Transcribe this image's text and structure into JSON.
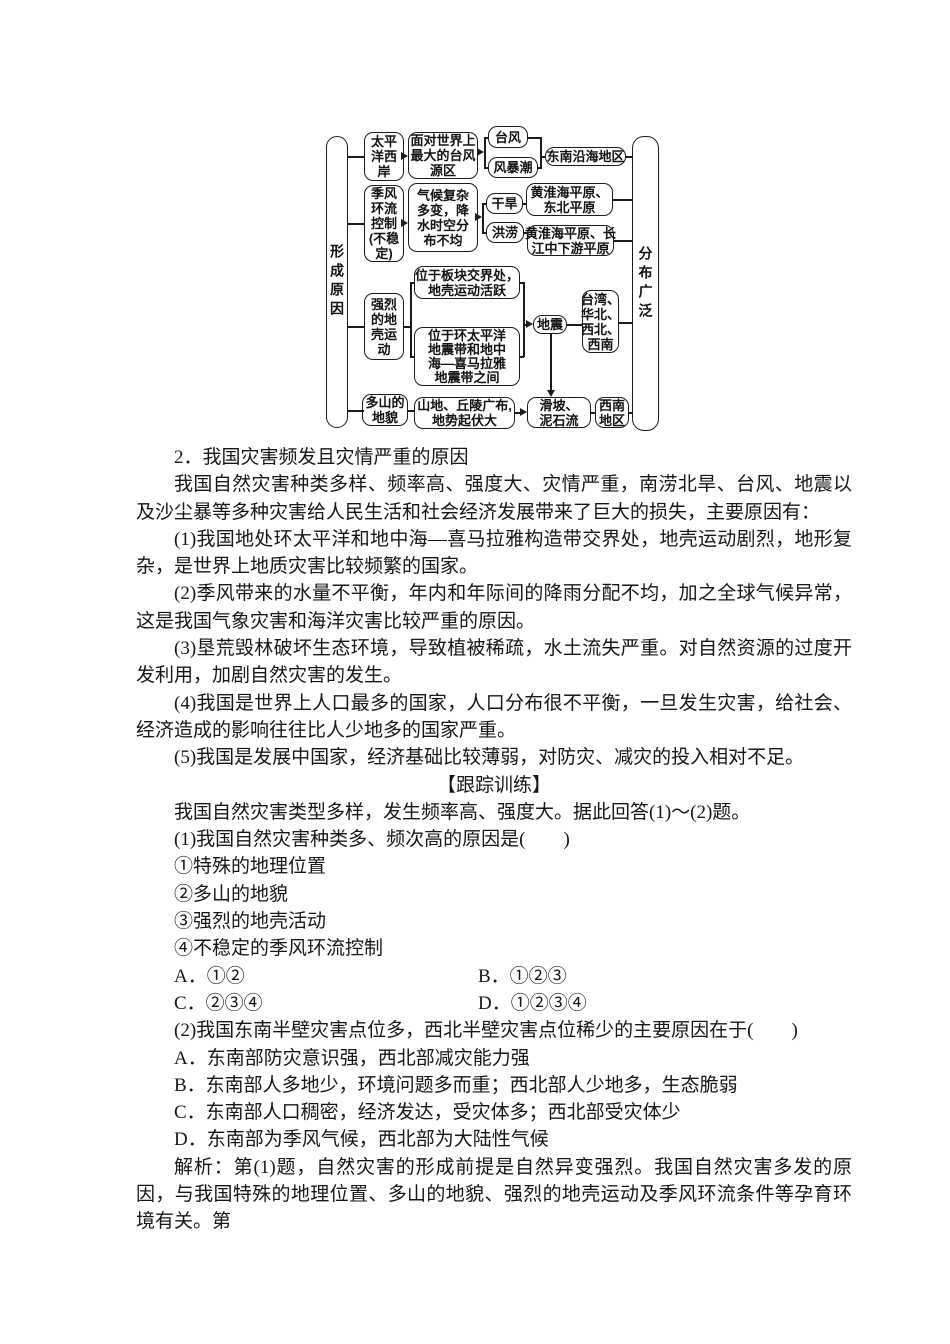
{
  "flowchart": {
    "cause_label": "形成原因",
    "distribution_label": "分布广泛",
    "nodes": {
      "pacific": "太平\n洋西\n岸",
      "monsoon": "季风\n环流\n控制\n(不稳\n定)",
      "crust": "强烈\n的地\n壳运\n动",
      "mountain": "多山的\n地貌",
      "typhoon_source": "面对世界上\n最大的台风\n源区",
      "climate": "气候复杂\n多变，降\n水时空分\n布不均",
      "plate_boundary": "位于板块交界处，\n地壳运动活跃",
      "seismic_belts": "位于环太平洋\n地震带和地中\n海—喜马拉雅\n地震带之间",
      "terrain": "山地、丘陵广布,\n地势起伏大",
      "typhoon": "台风",
      "storm_surge": "风暴潮",
      "drought": "干旱",
      "flood": "洪涝",
      "earthquake": "地震",
      "landslide": "滑坡、\n泥石流",
      "se_coast": "东南沿海地区",
      "huanghuai_northeast": "黄淮海平原、\n东北平原",
      "huanghuai_yangtze": "黄淮海平原、长\n江中下游平原",
      "tw_hb_xb_xn": "台湾、\n华北、\n西北、\n西南",
      "southwest": "西南\n地区"
    }
  },
  "body": {
    "blocks": [
      {
        "text": "2．我国灾害频发且灾情严重的原因"
      },
      {
        "text": "我国自然灾害种类多样、频率高、强度大、灾情严重，南涝北旱、台风、地震以及沙尘暴等多种灾害给人民生活和社会经济发展带来了巨大的损失，主要原因有："
      },
      {
        "text": "(1)我国地处环太平洋和地中海—喜马拉雅构造带交界处，地壳运动剧烈，地形复杂，是世界上地质灾害比较频繁的国家。"
      },
      {
        "text": "(2)季风带来的水量不平衡，年内和年际间的降雨分配不均，加之全球气候异常，这是我国气象灾害和海洋灾害比较严重的原因。"
      },
      {
        "text": "(3)垦荒毁林破坏生态环境，导致植被稀疏，水土流失严重。对自然资源的过度开发利用，加剧自然灾害的发生。"
      },
      {
        "text": "(4)我国是世界上人口最多的国家，人口分布很不平衡，一旦发生灾害，给社会、经济造成的影响往往比人少地多的国家严重。"
      },
      {
        "text": "(5)我国是发展中国家，经济基础比较薄弱，对防灾、减灾的投入相对不足。"
      },
      {
        "text": "【跟踪训练】"
      },
      {
        "text": "我国自然灾害类型多样，发生频率高、强度大。据此回答(1)～(2)题。"
      },
      {
        "text": "(1)我国自然灾害种类多、频次高的原因是(　　)"
      },
      {
        "text": "①特殊的地理位置"
      },
      {
        "text": "②多山的地貌"
      },
      {
        "text": "③强烈的地壳活动"
      },
      {
        "text": "④不稳定的季风环流控制"
      },
      {
        "left": "A．①②",
        "right": "B．①②③"
      },
      {
        "left": "C．②③④",
        "right": "D．①②③④"
      },
      {
        "text": "(2)我国东南半壁灾害点位多，西北半壁灾害点位稀少的主要原因在于(　　)"
      },
      {
        "text": "A．东南部防灾意识强，西北部减灾能力强"
      },
      {
        "text": "B．东南部人多地少，环境问题多而重；西北部人少地多，生态脆弱"
      },
      {
        "text": "C．东南部人口稠密，经济发达，受灾体多；西北部受灾体少"
      },
      {
        "text": "D．东南部为季风气候，西北部为大陆性气候"
      },
      {
        "text": "解析：第(1)题，自然灾害的形成前提是自然异变强烈。我国自然灾害多发的原因，与我国特殊的地理位置、多山的地貌、强烈的地壳运动及季风环流条件等孕育环境有关。第"
      }
    ]
  }
}
